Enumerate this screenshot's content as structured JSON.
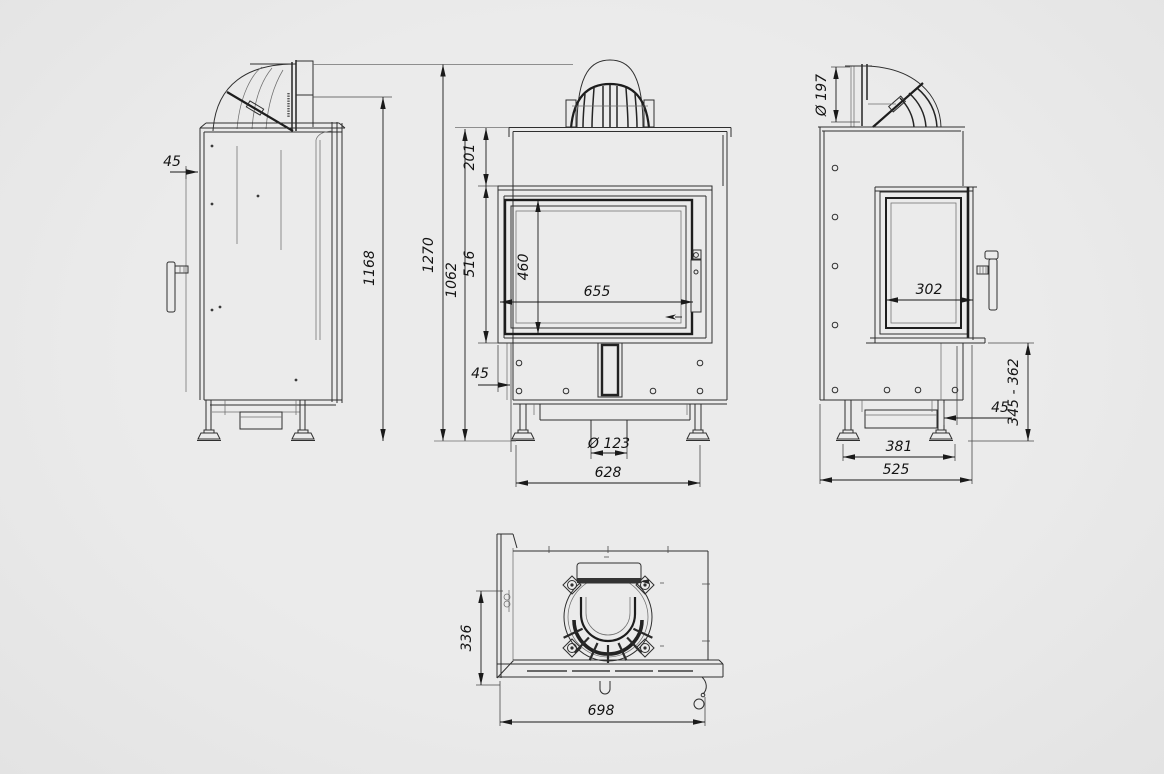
{
  "page": {
    "background": "#e9e9e9",
    "line_color": "#2f2f2f",
    "dimension_text_color": "#141414"
  },
  "dimensions": {
    "left": {
      "shield_offset": "45",
      "body_height": "1168"
    },
    "front": {
      "total_height": "1270",
      "plate_height": "1062",
      "collar_offset": "201",
      "door_height": "516",
      "glass_height": "460",
      "glass_width": "655",
      "frame_offset": "45",
      "outlet_diameter": "Ø 123",
      "feet_width": "628"
    },
    "right": {
      "flue_diameter": "Ø 197",
      "side_glass_width": "302",
      "leg_offset": "45",
      "base_height_range": "345 - 362",
      "feet_depth": "381",
      "depth": "525"
    },
    "top": {
      "wall_depth": "336",
      "overall_width": "698"
    }
  }
}
